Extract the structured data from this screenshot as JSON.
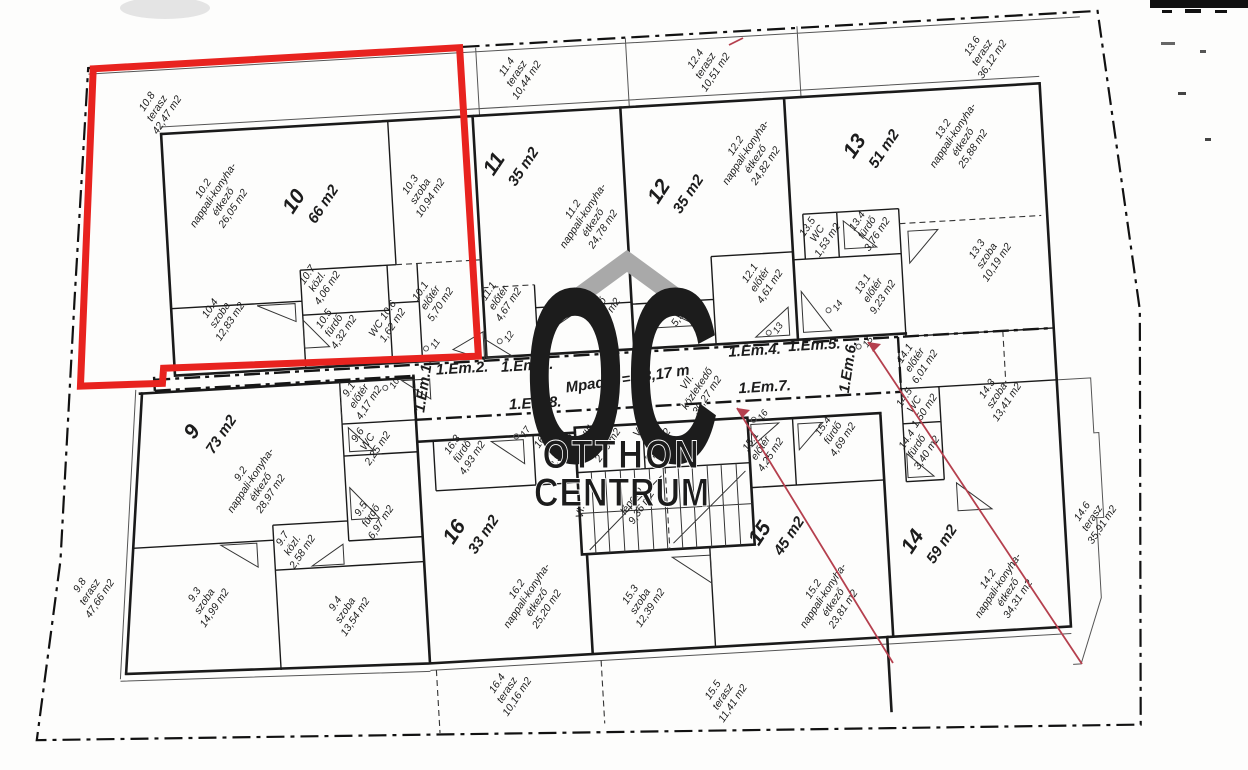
{
  "level_note": "Mpadló = +3,17 m",
  "watermark": {
    "letters": "OC",
    "line1": "OTTHON",
    "line2": "CENTRUM"
  },
  "corridor": {
    "markers": [
      "1.Em.1.",
      "1.Em.2.",
      "1.Em.3.",
      "1.Em.4.",
      "1.Em.5.",
      "1.Em.6.",
      "1.Em.7.",
      "1.Em.8."
    ],
    "hall": {
      "id": "VII.",
      "name": "közlekedő",
      "area": "30,27 m2"
    }
  },
  "core": {
    "elec": {
      "id": "VIII.",
      "name": "vill.h.",
      "area": "2,10 m2"
    },
    "lift": {
      "id": "V.",
      "name": "lift",
      "area": "2,89 m2"
    },
    "stairs": {
      "id": "VI.",
      "name": "lépcső",
      "area": "9,36 m2"
    }
  },
  "doors": [
    "10",
    "11",
    "12",
    "13",
    "14",
    "15",
    "16",
    "17"
  ],
  "apartments": [
    {
      "num": "9",
      "area": "73 m2",
      "rooms": [
        {
          "id": "9.1",
          "n1": "előtér",
          "area": "4,17 m2"
        },
        {
          "id": "9.2",
          "n1": "nappali-konyha-",
          "n2": "étkező",
          "area": "28,97 m2"
        },
        {
          "id": "9.3",
          "n1": "szoba",
          "area": "14,99 m2"
        },
        {
          "id": "9.4",
          "n1": "szoba",
          "area": "13,54 m2"
        },
        {
          "id": "9.5",
          "n1": "fürdő",
          "area": "6,97 m2"
        },
        {
          "id": "9.6",
          "n1": "WC",
          "area": "2,25 m2"
        },
        {
          "id": "9.7",
          "n1": "közl.",
          "area": "2,58 m2"
        },
        {
          "id": "9.8",
          "n1": "terasz",
          "area": "47,66 m2"
        }
      ]
    },
    {
      "num": "10",
      "area": "66 m2",
      "rooms": [
        {
          "id": "10.1",
          "n1": "előtér",
          "area": "5,70 m2"
        },
        {
          "id": "10.2",
          "n1": "nappali-konyha-",
          "n2": "étkező",
          "area": "26,05 m2"
        },
        {
          "id": "10.3",
          "n1": "szoba",
          "area": "10,94 m2"
        },
        {
          "id": "10.4",
          "n1": "szoba",
          "area": "12,83 m2"
        },
        {
          "id": "10.5",
          "n1": "fürdő",
          "area": "4,32 m2"
        },
        {
          "id": "WC 10.6",
          "area": "1,62 m2"
        },
        {
          "id": "10.7",
          "n1": "közl.",
          "area": "4,06 m2"
        },
        {
          "id": "10.8",
          "n1": "terasz",
          "area": "42,47 m2"
        }
      ]
    },
    {
      "num": "11",
      "area": "35 m2",
      "rooms": [
        {
          "id": "11.1",
          "n1": "előtér",
          "area": "4,67 m2"
        },
        {
          "id": "11.2",
          "n1": "nappali-konyha-",
          "n2": "étkező",
          "area": "24,78 m2"
        },
        {
          "id": "11.3",
          "n1": "fürdő",
          "area": "5,55 m2"
        },
        {
          "id": "11.4",
          "n1": "terasz",
          "area": "10,44 m2"
        }
      ]
    },
    {
      "num": "12",
      "area": "35 m2",
      "rooms": [
        {
          "id": "12.1",
          "n1": "előtér",
          "area": "4,61 m2"
        },
        {
          "id": "12.2",
          "n1": "nappali-konyha-",
          "n2": "étkező",
          "area": "24,82 m2"
        },
        {
          "id": "12.3",
          "n1": "fürdő",
          "area": "5,55 m2"
        },
        {
          "id": "12.4",
          "n1": "terasz",
          "area": "10,51 m2"
        }
      ]
    },
    {
      "num": "13",
      "area": "51 m2",
      "rooms": [
        {
          "id": "13.1",
          "n1": "előtér",
          "area": "9,23 m2"
        },
        {
          "id": "13.2",
          "n1": "nappali-konyha-",
          "n2": "étkező",
          "area": "25,88 m2"
        },
        {
          "id": "13.3",
          "n1": "szoba",
          "area": "10,19 m2"
        },
        {
          "id": "13.4",
          "n1": "fürdő",
          "area": "3,76 m2"
        },
        {
          "id": "13.5",
          "n1": "WC",
          "area": "1,53 m2"
        },
        {
          "id": "13.6",
          "n1": "terasz",
          "area": "36,12 m2"
        }
      ]
    },
    {
      "num": "14",
      "area": "59 m2",
      "rooms": [
        {
          "id": "14.1",
          "n1": "előtér",
          "area": "6,01 m2"
        },
        {
          "id": "14.2",
          "n1": "nappali-konyha-",
          "n2": "étkező",
          "area": "34,31 m2"
        },
        {
          "id": "14.3",
          "n1": "szoba",
          "area": "13,41 m2"
        },
        {
          "id": "14.4",
          "n1": "fürdő",
          "area": "3,40 m2"
        },
        {
          "id": "14.5",
          "n1": "WC",
          "area": "1,50 m2"
        },
        {
          "id": "14.6",
          "n1": "terasz",
          "area": "35,91 m2"
        }
      ]
    },
    {
      "num": "15",
      "area": "45 m2",
      "rooms": [
        {
          "id": "15.1",
          "n1": "előtér",
          "area": "4,25 m2"
        },
        {
          "id": "15.2",
          "n1": "nappali-konyha-",
          "n2": "étkező",
          "area": "23,81 m2"
        },
        {
          "id": "15.3",
          "n1": "szoba",
          "area": "12,39 m2"
        },
        {
          "id": "15.4",
          "n1": "fürdő",
          "area": "4,69 m2"
        },
        {
          "id": "15.5",
          "n1": "terasz",
          "area": "11,41 m2"
        }
      ]
    },
    {
      "num": "16",
      "area": "33 m2",
      "rooms": [
        {
          "id": "16.1",
          "n1": "előtér",
          "area": "3,34 m2"
        },
        {
          "id": "16.2",
          "n1": "nappali-konyha-",
          "n2": "étkező",
          "area": "25,20 m2"
        },
        {
          "id": "16.3",
          "n1": "fürdő",
          "area": "4,93 m2"
        },
        {
          "id": "16.4",
          "n1": "terasz",
          "area": "10,16 m2"
        }
      ]
    }
  ],
  "colors": {
    "highlight": "#e8231f",
    "annotation": "#b5404e",
    "wall": "#1a1a1a",
    "watermark": "#a9a9a9"
  }
}
